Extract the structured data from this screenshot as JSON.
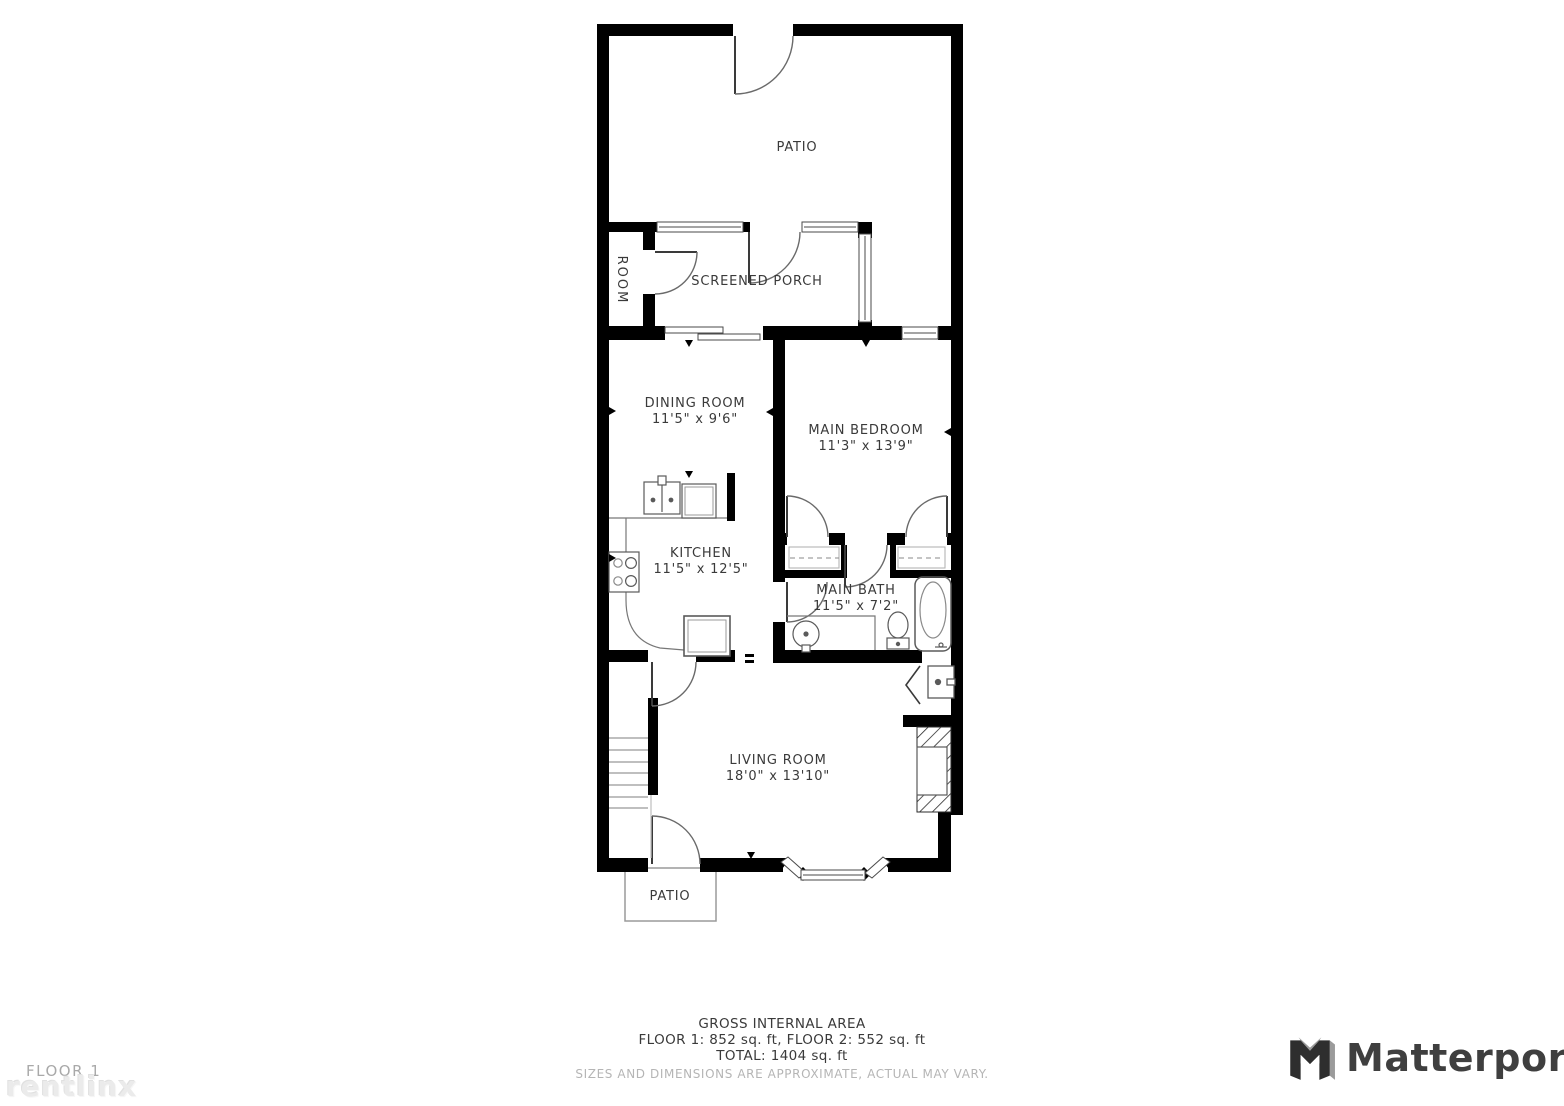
{
  "rooms": {
    "patio_top": {
      "label": "PATIO"
    },
    "room": {
      "label": "ROOM"
    },
    "screened_porch": {
      "label": "SCREENED PORCH"
    },
    "dining_room": {
      "label": "DINING ROOM",
      "dimensions": "11'5\" x 9'6\""
    },
    "main_bedroom": {
      "label": "MAIN BEDROOM",
      "dimensions": "11'3\" x 13'9\""
    },
    "kitchen": {
      "label": "KITCHEN",
      "dimensions": "11'5\" x 12'5\""
    },
    "main_bath": {
      "label": "MAIN BATH",
      "dimensions": "11'5\" x 7'2\""
    },
    "living_room": {
      "label": "LIVING ROOM",
      "dimensions": "18'0\" x 13'10\""
    },
    "patio_bottom": {
      "label": "PATIO"
    }
  },
  "footer": {
    "title": "GROSS INTERNAL AREA",
    "floors": "FLOOR 1: 852 sq. ft, FLOOR 2: 552 sq. ft",
    "total": "TOTAL: 1404 sq. ft",
    "disclaimer": "SIZES AND DIMENSIONS ARE APPROXIMATE, ACTUAL MAY VARY."
  },
  "watermarks": {
    "floor_label": "FLOOR 1",
    "provider": "rentlinx",
    "brand": "Matterport"
  },
  "colors": {
    "wall": "#000000",
    "label_text": "#3a3a3a",
    "disclaimer_text": "#b5b5b5",
    "floor_label_text": "#a9a9a9",
    "provider_watermark": "#ebebeb",
    "brand_text": "#3f3f3f"
  }
}
